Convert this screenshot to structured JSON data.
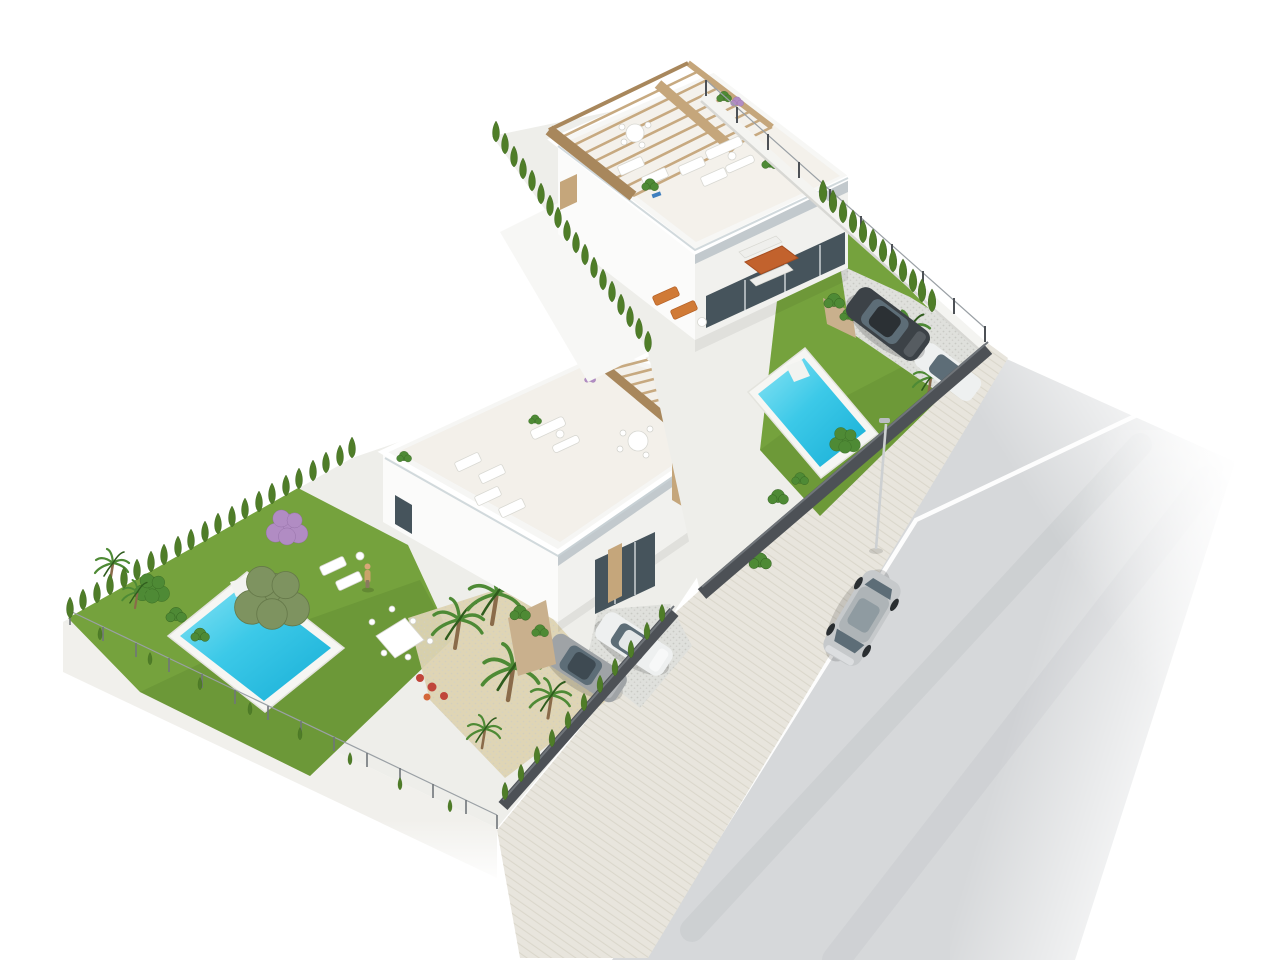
{
  "meta": {
    "type": "architectural-3d-render",
    "view": "aerial isometric",
    "description": "Photorealistic aerial 3D render of an L-shaped corner parcel with two modern white single-family villas, each with a roof terrace and wooden pergola, private turquoise pools, landscaped gardens with cypress hedges, olive tree and palms, gravel driveways with parked cars, and a light asphalt road with one silver car driving past a street lamp."
  },
  "scene": {
    "villas": 2,
    "pools": 2,
    "pergolas": 2,
    "parked_cars": 4,
    "cars_on_road": 1,
    "street_lamps": 1,
    "people": 1,
    "road_markings": "single solid white center line",
    "garden_features": [
      "cypress hedgerows",
      "olive tree",
      "palm trees",
      "purple flowering tree",
      "red flower bed",
      "lawns",
      "sun loungers",
      "outdoor dining sets",
      "rooftop lounge furniture"
    ]
  },
  "colors": {
    "background": "#ffffff",
    "road": "#d6d8da",
    "road_line": "#ffffff",
    "road_track": "#b9bdc0",
    "sidewalk": "#e8e5dd",
    "sidewalk_stripe": "#d7d3c7",
    "plinth": "#f2f1ed",
    "patio": "#eeeeea",
    "lawn": "#75a23d",
    "lawn_shade": "#567e2a",
    "gravel": "#dfe0dc",
    "sand": "#ddd3b2",
    "villa_white": "#fbfbfa",
    "villa_side": "#f1f1ee",
    "overhang": "#bac2c7",
    "glass": "#46545c",
    "pergola": "#c5a67b",
    "pergola_dark": "#a8875c",
    "pergola_floor": "#efe9df",
    "planter": "#c9b08d",
    "pool_deck": "#f6f6f3",
    "pool_light": "#8ae4f4",
    "pool_mid": "#3cc9e8",
    "pool_deep": "#17aed6",
    "hedge": "#4f7d28",
    "hedge_dark": "#3a621c",
    "foliage": "#4e8a35",
    "foliage_dark": "#2f5c1d",
    "olive": "#7e9360",
    "olive_dark": "#66794a",
    "trunk": "#8a6b4a",
    "flower_purple": "#b18cc3",
    "flower_red": "#c0453a",
    "fence_dark": "#4d5156",
    "fence_hl": "#70757a",
    "fence_light": "#9aa0a5",
    "wall_white": "#f4f4f1",
    "wall_shade": "#d8d8d4",
    "car_dark": "#3c4247",
    "car_dark_roof": "#2b3034",
    "car_silver": "#c6c9cb",
    "car_white": "#eef0f0",
    "car_gray": "#9fa3a6",
    "car_glass": "#5d6d77",
    "lamp": "#cdd0d2",
    "skin": "#d9a778",
    "outfit": "#caa36a",
    "table_orange": "#c2622d"
  }
}
